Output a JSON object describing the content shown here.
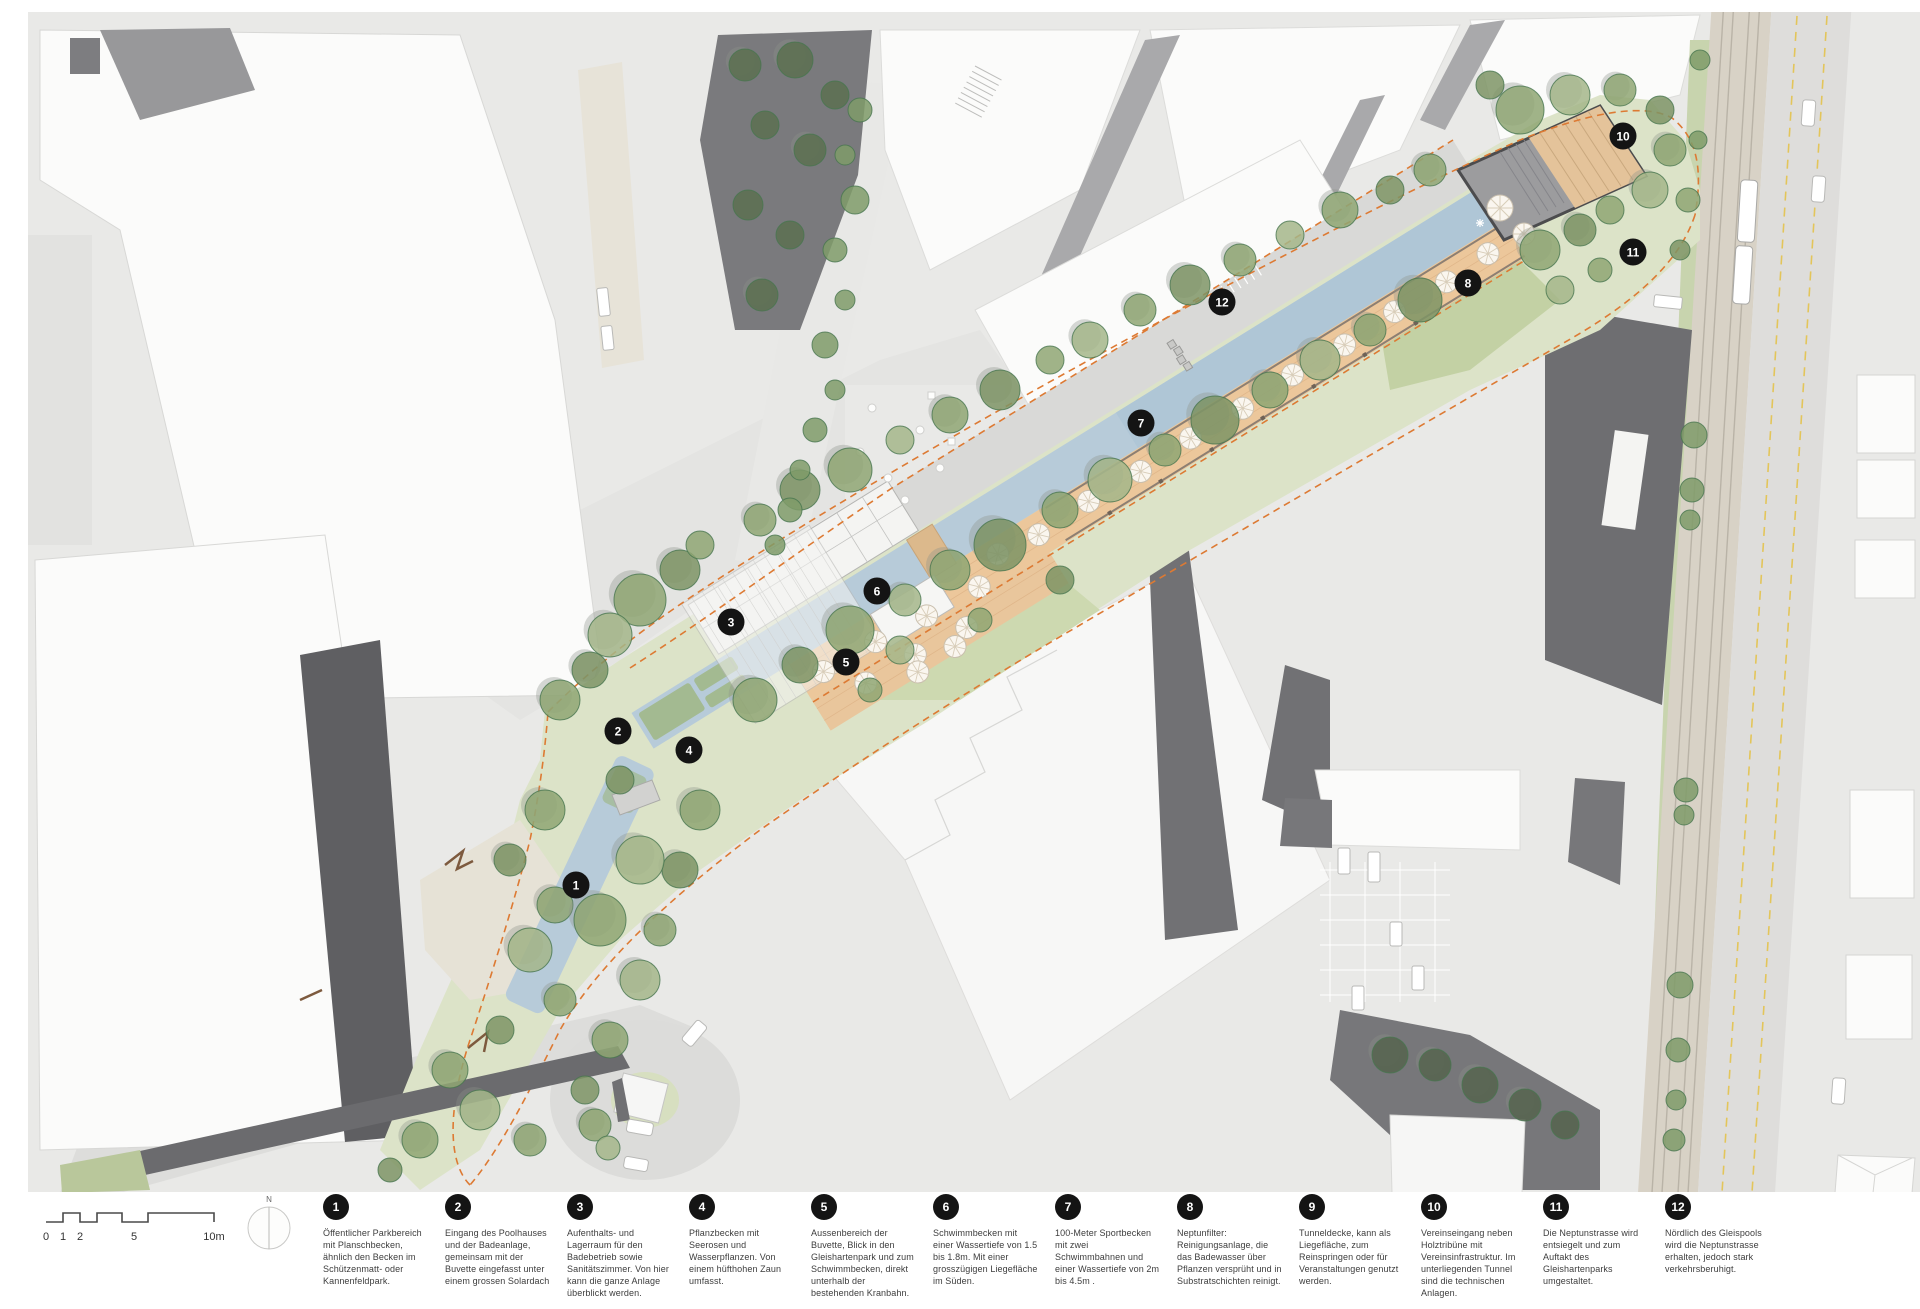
{
  "map": {
    "name": "Gleishartenpark / Gleispool site plan",
    "markers": [
      {
        "number": "1",
        "x": 576,
        "y": 885
      },
      {
        "number": "2",
        "x": 618,
        "y": 731
      },
      {
        "number": "3",
        "x": 731,
        "y": 622
      },
      {
        "number": "4",
        "x": 689,
        "y": 750
      },
      {
        "number": "5",
        "x": 846,
        "y": 662
      },
      {
        "number": "6",
        "x": 877,
        "y": 591
      },
      {
        "number": "7",
        "x": 1141,
        "y": 423
      },
      {
        "number": "8",
        "x": 1468,
        "y": 283
      },
      {
        "number": "10",
        "x": 1623,
        "y": 136
      },
      {
        "number": "11",
        "x": 1633,
        "y": 252
      },
      {
        "number": "12",
        "x": 1222,
        "y": 302
      }
    ]
  },
  "legend": {
    "scalebar": {
      "labels": [
        "0",
        "1",
        "2",
        "5",
        "10m"
      ]
    },
    "compass": {
      "label": "N"
    },
    "items": [
      {
        "number": "1",
        "text": "Öffentlicher Parkbereich mit Planschbecken, ähnlich den Becken im Schützenmatt- oder Kannenfeldpark."
      },
      {
        "number": "2",
        "text": "Eingang des Poolhauses und der Badeanlage, gemeinsam mit der Buvette eingefasst unter einem grossen Solardach"
      },
      {
        "number": "3",
        "text": "Aufenthalts- und Lagerraum für den Badebetrieb sowie Sanitätszimmer. Von hier kann die ganze Anlage überblickt werden."
      },
      {
        "number": "4",
        "text": "Pflanzbecken mit Seerosen und Wasserpflanzen. Von einem hüfthohen Zaun umfasst."
      },
      {
        "number": "5",
        "text": "Aussenbereich der Buvette, Blick in den Gleishartenpark und zum Schwimmbecken, direkt unterhalb der bestehenden Kranbahn."
      },
      {
        "number": "6",
        "text": "Schwimmbecken mit einer Wassertiefe von 1.5 bis 1.8m. Mit einer grosszügigen Liegefläche im Süden."
      },
      {
        "number": "7",
        "text": "100-Meter Sportbecken mit zwei Schwimmbahnen und einer Wassertiefe von 2m bis 4.5m ."
      },
      {
        "number": "8",
        "text": "Neptunfilter: Reinigungsanlage, die das Badewasser über Pflanzen versprüht und in Substratschichten reinigt."
      },
      {
        "number": "9",
        "text": "Tunneldecke, kann als Liegefläche, zum Reinspringen oder für Veranstaltungen genutzt werden."
      },
      {
        "number": "10",
        "text": "Vereinseingang neben Holztribüne mit Vereinsinfrastruktur. Im unterliegenden Tunnel sind die technischen Anlagen."
      },
      {
        "number": "11",
        "text": "Die Neptunstrasse wird entsiegelt und zum Auftakt des Gleishartenparks umgestaltet."
      },
      {
        "number": "12",
        "text": "Nördlich des Gleispools wird die Neptunstrasse erhalten, jedoch stark verkehrsberuhigt."
      }
    ]
  },
  "colors": {
    "water": "#b7cbd9",
    "park_green": "#dce3c8",
    "meadow_green": "#c3d1a4",
    "tree_green": "#8fa673",
    "deck_orange": "#ecc79b",
    "path_orange_dash": "#dd7a33",
    "marker_black": "#141414",
    "rail_beige": "#d8d2c6",
    "road_gray": "#e0e0de",
    "building_white": "#fbfbfa",
    "shadow_gray": "#6e6e71",
    "lane_yellow": "#e3c55a"
  }
}
